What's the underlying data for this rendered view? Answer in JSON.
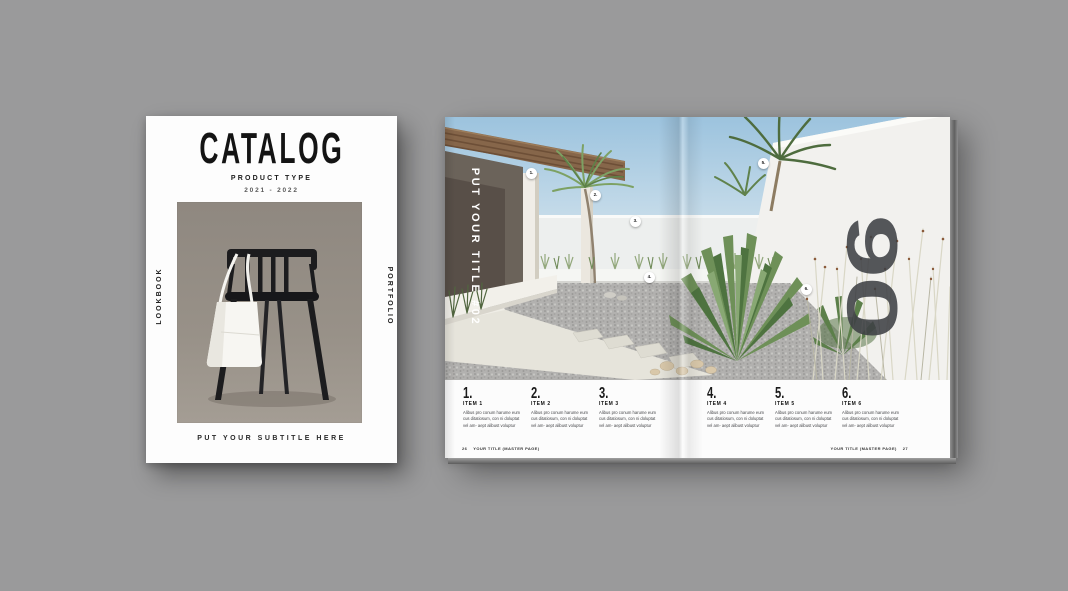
{
  "canvas": {
    "background": "#9a9a9b"
  },
  "colors": {
    "section_number": "#3e4044",
    "sky": "#9cc3de",
    "wood": "#86664a",
    "gravel": "#b2b1af",
    "chair": "#1c1c1e",
    "cover_backdrop": "#918a82",
    "page": "#fdfdfd"
  },
  "cover": {
    "title": "CATALOG",
    "subtitle": "PRODUCT TYPE",
    "years": "2021 - 2022",
    "spine_left": "LOOKBOOK",
    "spine_right": "PORTFOLIO",
    "bottom_tagline": "PUT YOUR SUBTITLE HERE"
  },
  "spread": {
    "vertical_title": "PUT YOUR TITLE #02",
    "section_number": "06",
    "markers": [
      {
        "label": "1."
      },
      {
        "label": "2."
      },
      {
        "label": "3."
      },
      {
        "label": "4."
      },
      {
        "label": "5."
      },
      {
        "label": "6."
      }
    ],
    "items": [
      {
        "number": "1.",
        "label": "ITEM 1",
        "body": "Alibus pro conum harume eum cus ditatiosum, con ni doluptat vel am- aept alibust voluptur"
      },
      {
        "number": "2.",
        "label": "ITEM 2",
        "body": "Alibus pro conum harume eum cus ditatiosum, con ni doluptat vel am- aept alibust voluptur"
      },
      {
        "number": "3.",
        "label": "ITEM 3",
        "body": "Alibus pro conum harume eum cus ditatiosum, con ni doluptat vel am- aept alibust voluptur"
      },
      {
        "number": "4.",
        "label": "ITEM 4",
        "body": "Alibus pro conum harume eum cus ditatiosum, con ni doluptat vel am- aept alibust voluptur"
      },
      {
        "number": "5.",
        "label": "ITEM 5",
        "body": "Alibus pro conum harume eum cus ditatiosum, con ni doluptat vel am- aept alibust voluptur"
      },
      {
        "number": "6.",
        "label": "ITEM 6",
        "body": "Alibus pro conum harume eum cus ditatiosum, con ni doluptat vel am- aept alibust voluptur"
      }
    ],
    "footer_left": {
      "page_number": "26",
      "label": "YOUR TITLE (MASTER PAGE)"
    },
    "footer_right": {
      "page_number": "27",
      "label": "YOUR TITLE (MASTER PAGE)"
    }
  }
}
